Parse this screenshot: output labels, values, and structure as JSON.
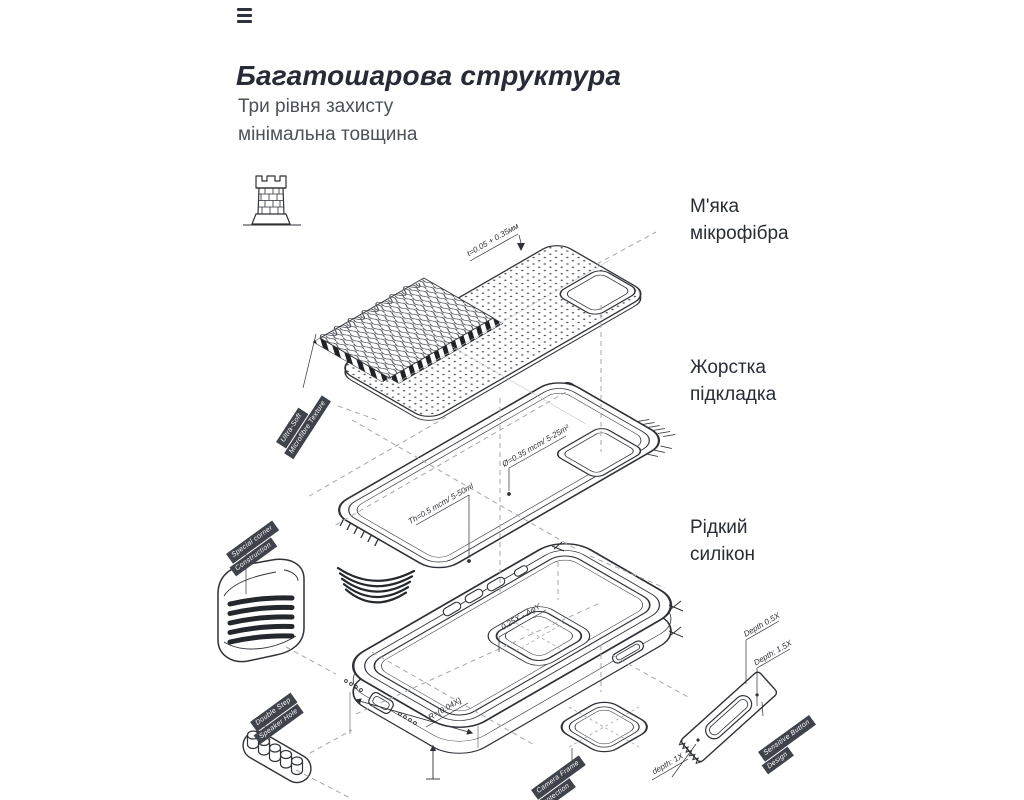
{
  "header": {
    "title": "Багатошарова структура",
    "subtitle": "Три рівня захисту\nмінімальна товщина"
  },
  "icons": {
    "menu": "hamburger-menu",
    "fortress": "castle-tower"
  },
  "layer_labels": {
    "microfiber": "М'яка\nмікрофібра",
    "hard_liner": "Жорстка\nпідкладка",
    "silicone": "Рідкий\nсилікон"
  },
  "tags": {
    "texture": {
      "line1": "Ultra-Soft",
      "line2": "Microfibre Texture"
    },
    "corner": {
      "line1": "Special corner",
      "line2": "Construction"
    },
    "speaker": {
      "line1": "Double Step",
      "line2": "Speaker Hole"
    },
    "camera": {
      "line1": "Camera Frame",
      "line2": "Protection"
    },
    "button": {
      "line1": "Sensitive Button",
      "line2": "Design"
    }
  },
  "annotations": {
    "sheet_thickness": "t=0.05 + 0.35мм",
    "liner_hole": "Ø=0.35 mcm/ 5-25m²",
    "liner_thickness": "Th=0.5 mcm/ 5-50ml",
    "case_edge": "0.25X - ΔφY",
    "case_radius": "R=(0.04X)",
    "button_depth_a": "Depth 0.5X",
    "button_depth_b": "Depth: 1.5X",
    "camera_depth": "depth: 1X"
  },
  "colors": {
    "ink": "#2e3137",
    "title": "#262b36",
    "body_text": "#4b505b",
    "tag_bg": "#3f434b",
    "dash": "#a3a7ae"
  }
}
